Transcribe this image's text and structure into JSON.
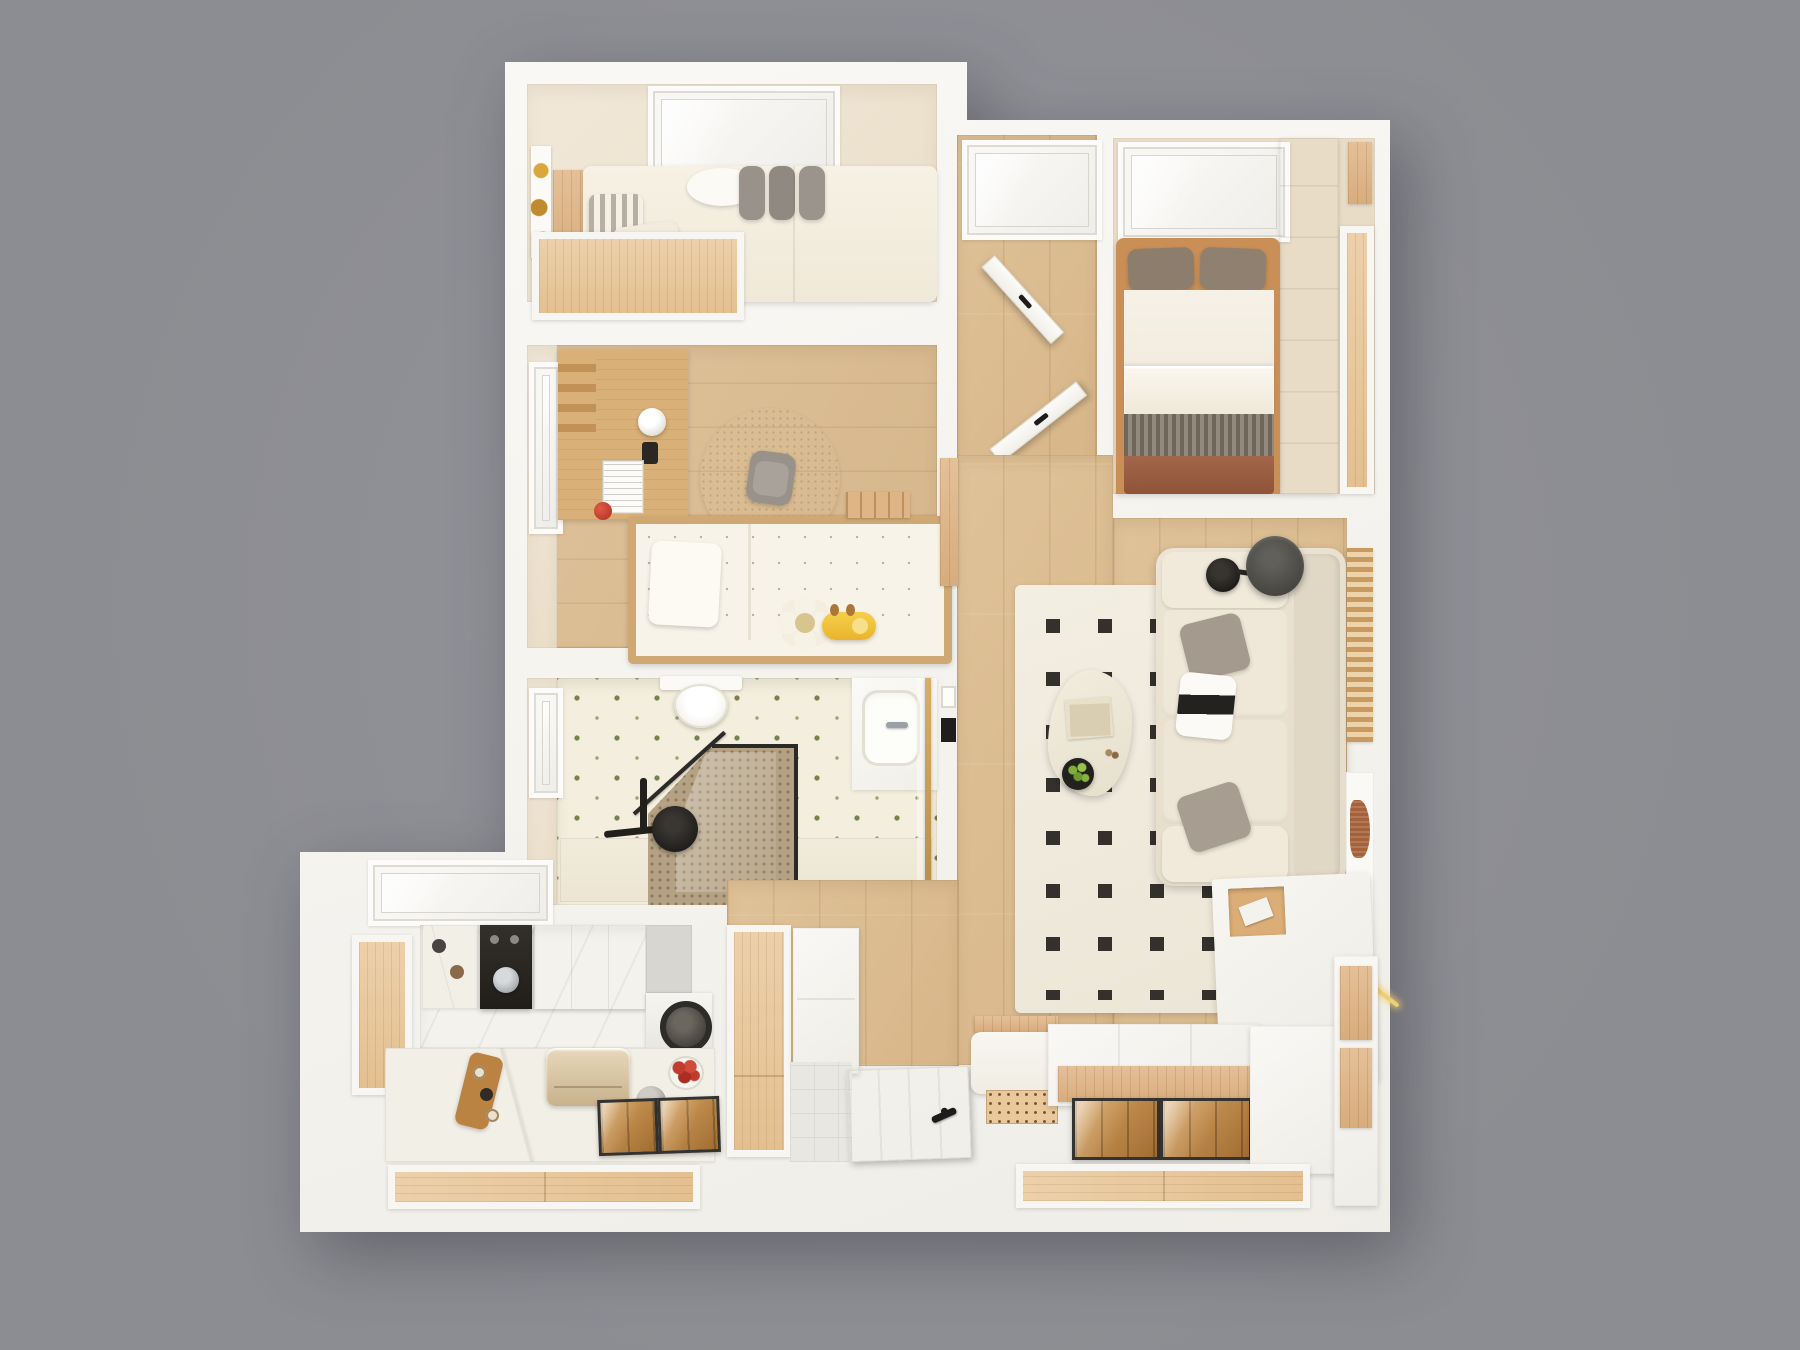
{
  "scene": {
    "description": "Top-down 3D render of a small apartment floor plan on a gray background",
    "view": "top-down",
    "background_color": "#8f9095",
    "render_style": "photorealistic 3D floor plan, no visible text"
  },
  "palette": {
    "background": "#8f9095",
    "walls": "#f7f6f2",
    "wood_floor": "#ddbd90",
    "light_wood_panel": "#e9c697",
    "beige_floor": "#efe5d3",
    "bathroom_tile_accent_green": "#75834f",
    "kitchen_cabinet_olive": "#75794f",
    "rug": "#f1ece0",
    "rug_dots": "#34312c",
    "sofa": "#e9e1d1",
    "bedding_rust": "#a2664a",
    "bedding_tweed": "#7d7468",
    "brass_accent": "#c79b52",
    "fixtures_black": "#22201d"
  },
  "rooms": [
    {
      "id": "bedroom-main",
      "name": "Main bedroom (top left)",
      "furniture": [
        "double bed",
        "striped pillow",
        "cream pillow",
        "cloud cushion",
        "three grey cushions",
        "wall artwork",
        "wardrobe panel",
        "built-in closet",
        "window"
      ]
    },
    {
      "id": "bedroom-second",
      "name": "Second bedroom (top right)",
      "furniture": [
        "double bed with taupe pillows",
        "white sheet",
        "folded duvet",
        "tweed blanket",
        "rust bed skirt",
        "white wardrobe",
        "wood closet panel",
        "window"
      ]
    },
    {
      "id": "kids-room",
      "name": "Kids room",
      "furniture": [
        "single bed with patterned duvet",
        "white pillow",
        "flower plush",
        "giraffe plush",
        "desk with lamp",
        "red toy",
        "books",
        "desk chair",
        "round rug",
        "magazine rack",
        "window"
      ]
    },
    {
      "id": "bathroom",
      "name": "Bathroom",
      "furniture": [
        "toilet",
        "walk-in shower with black-framed glass",
        "mosaic shower floor",
        "black shower set",
        "shower tray",
        "vanity with basin and faucet",
        "sliding door with brass frame",
        "window"
      ]
    },
    {
      "id": "kitchen",
      "name": "Kitchen",
      "furniture": [
        "skylight window",
        "wood door panel",
        "olive green cabinets",
        "coffee appliance tower",
        "grey backsplash",
        "washing machine",
        "marble counter",
        "cutting board",
        "bread box",
        "fruit bowl",
        "pot",
        "double sink trays",
        "wood drawer front"
      ]
    },
    {
      "id": "living-room",
      "name": "Living room",
      "furniture": [
        "cream rug with black square grid",
        "organic coffee table",
        "stacked books",
        "potted plant",
        "three-seat sofa",
        "grey throw pillows",
        "black and white pillow",
        "black floor lamp",
        "dark cylinder side table",
        "wood slat wall panel",
        "wall artwork with arch shapes",
        "media sideboard with open shelf",
        "LED strip light",
        "light switch",
        "wall screen"
      ]
    },
    {
      "id": "entry-hall",
      "name": "Entry hall",
      "furniture": [
        "front door with black handle",
        "grey tile threshold",
        "shoe cabinet",
        "tall wood cabinet",
        "bench with white cushion",
        "perforated shoe mat",
        "glass-top display platform",
        "storage platform",
        "wood drawer fronts"
      ]
    }
  ],
  "doors": [
    {
      "id": "door-main-bedroom",
      "state": "open"
    },
    {
      "id": "door-second-bedroom",
      "state": "open"
    },
    {
      "id": "door-front-entry",
      "state": "closed"
    }
  ]
}
